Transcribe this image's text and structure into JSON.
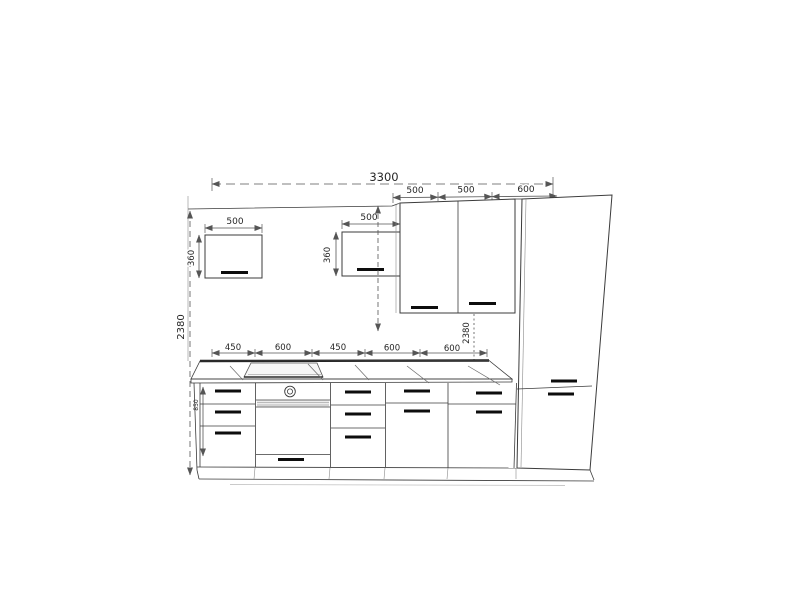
{
  "page": {
    "background": "#ffffff"
  },
  "drawing": {
    "type": "kitchen-elevation-blueprint",
    "colors": {
      "line": "#3b3b3b",
      "dimension": "#555555",
      "handle": "#0d0d0d"
    },
    "dims": {
      "total_width": "3300",
      "height_left": "2380",
      "height_right": "2380",
      "upper_widths": [
        "500",
        "500",
        "600"
      ],
      "wall_cab1_width": "500",
      "wall_cab1_height": "360",
      "wall_cab2_width": "500",
      "wall_cab2_height": "360",
      "counter_widths": [
        "450",
        "600",
        "450",
        "600",
        "600"
      ],
      "base_height": "850"
    }
  }
}
